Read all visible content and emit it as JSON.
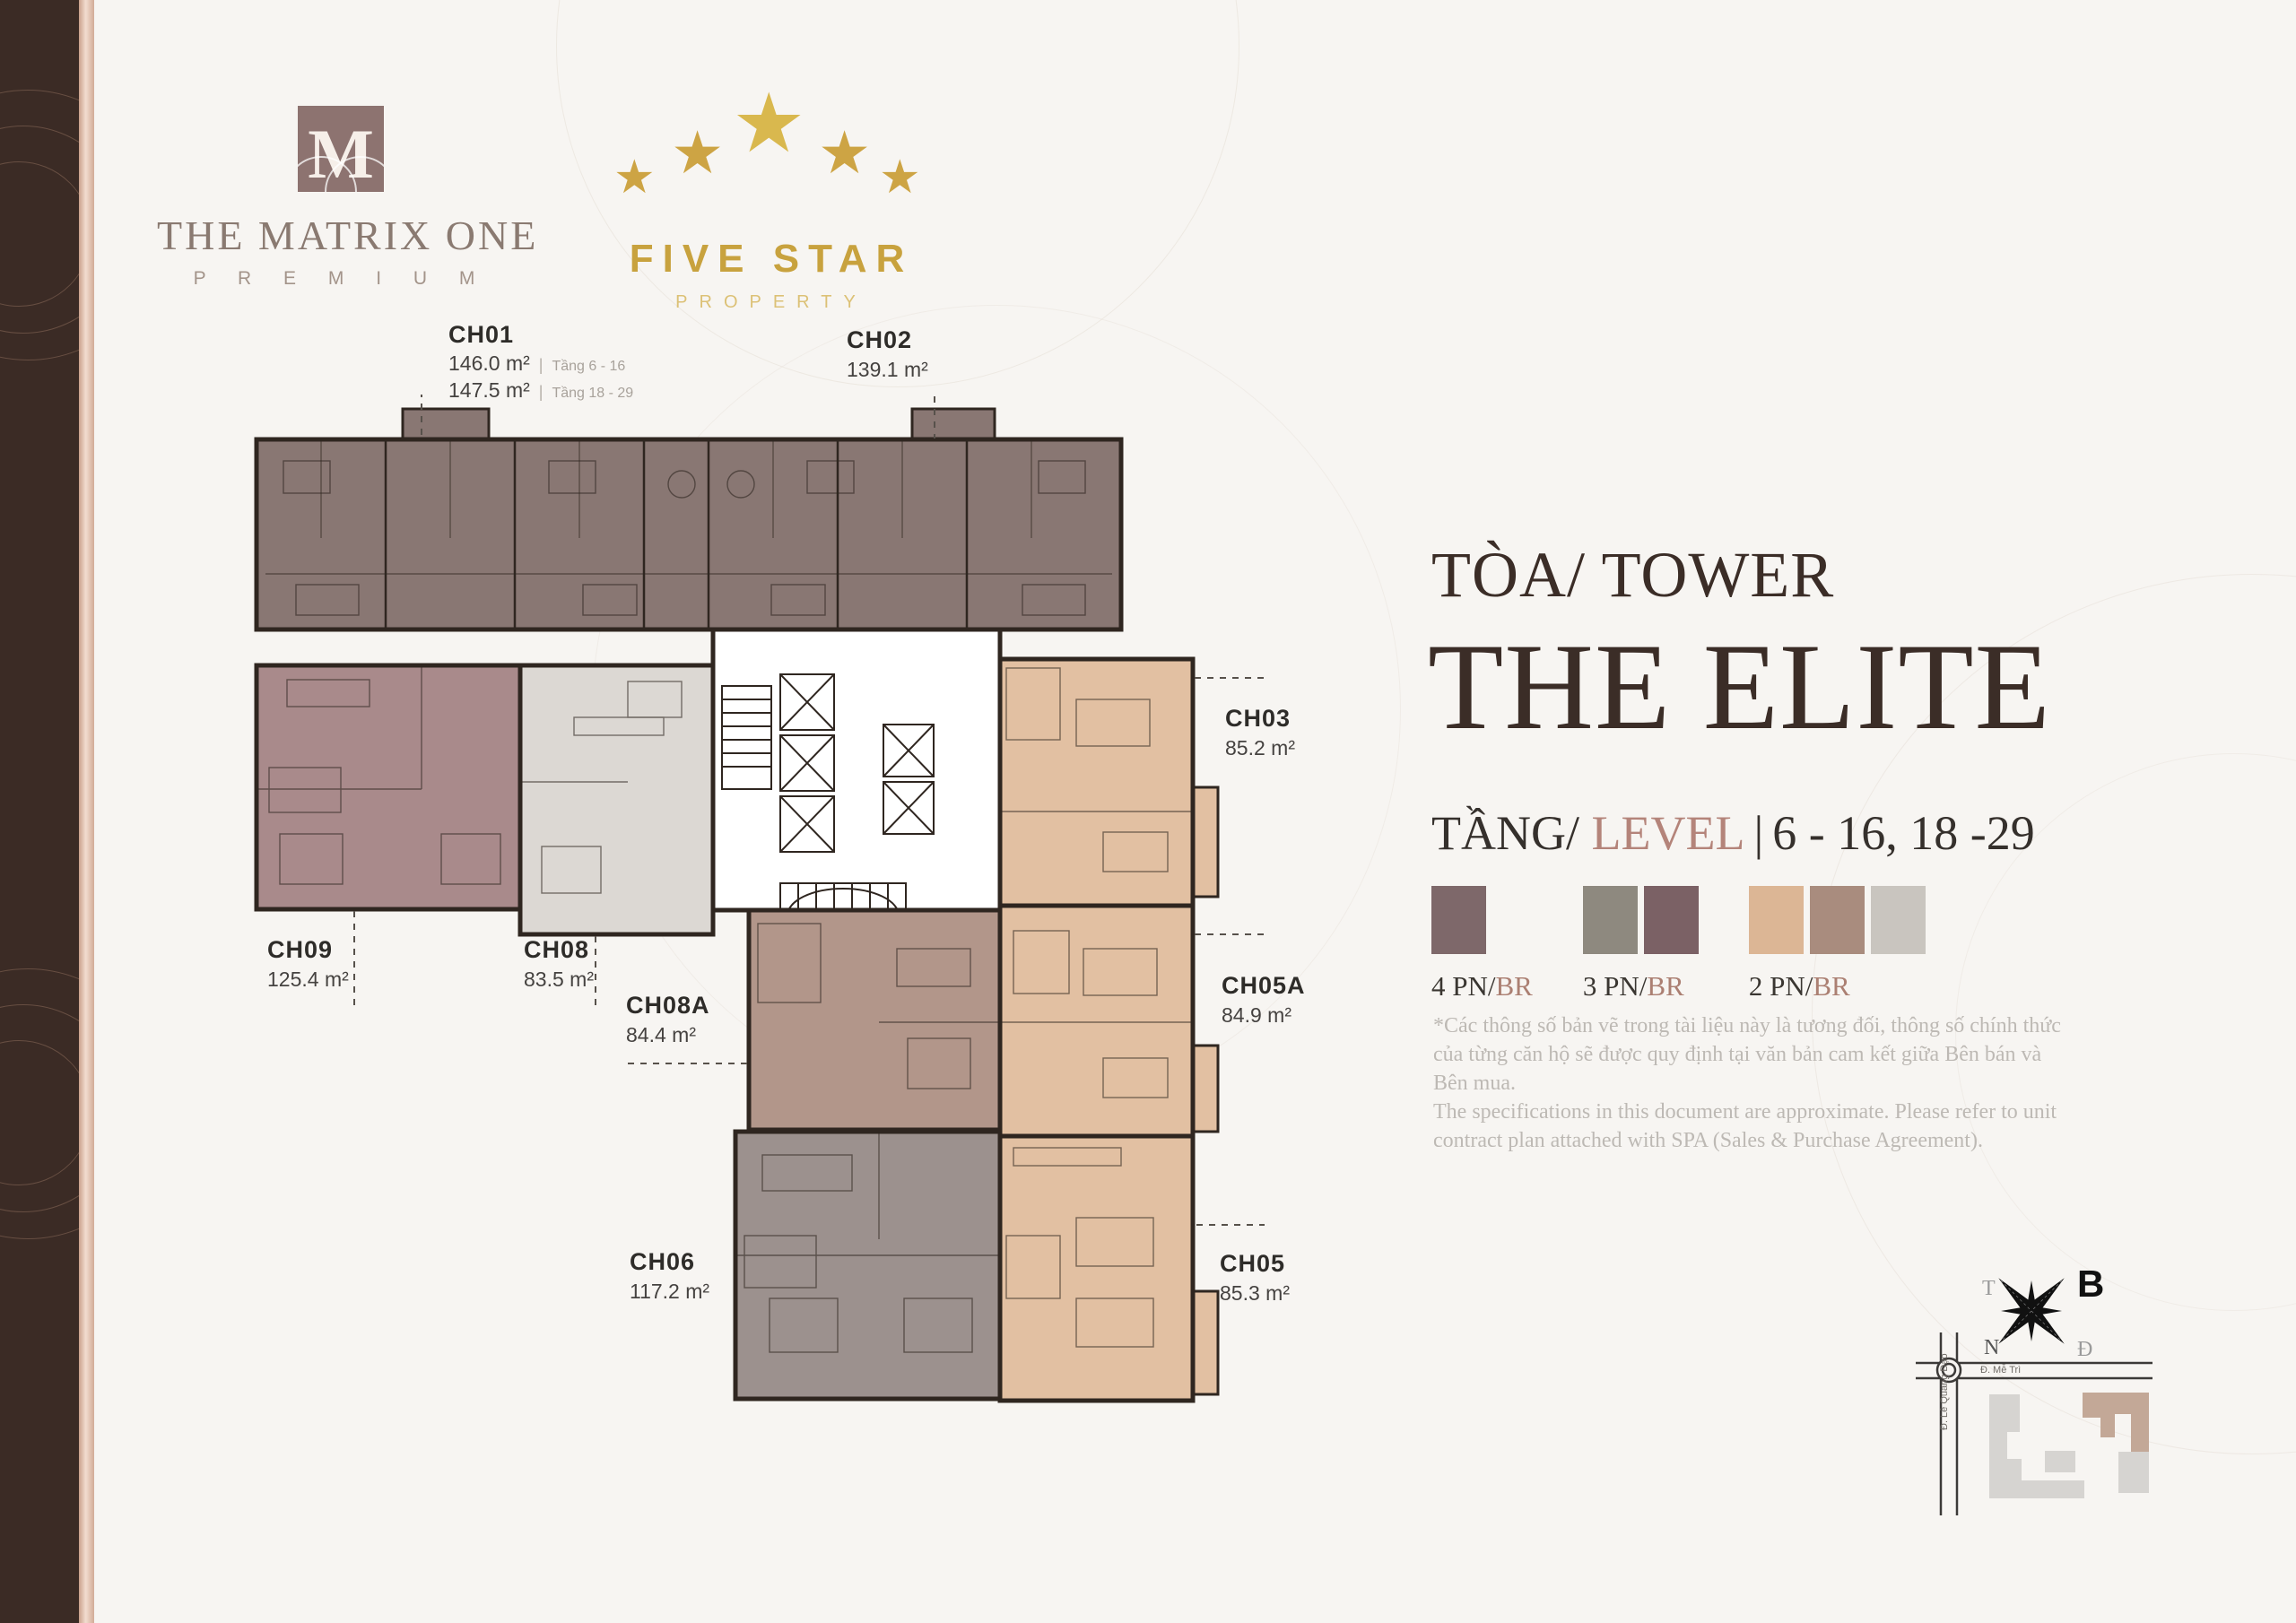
{
  "brand": {
    "matrix": {
      "monogram": "M",
      "title": "THE MATRIX ONE",
      "subtitle": "P R E M I U M"
    },
    "five_star": {
      "title": "FIVE STAR",
      "subtitle": "PROPERTY",
      "star_icon": "★"
    }
  },
  "tower": {
    "prefix": "TÒA/ TOWER",
    "name": "THE ELITE"
  },
  "level": {
    "vi": "TẦNG/ ",
    "en": "LEVEL",
    "separator": "|",
    "range": "6 - 16, 18 -29"
  },
  "legend": {
    "items": [
      {
        "pn": "4 PN/",
        "br": "BR",
        "colors": [
          "#7e686a"
        ]
      },
      {
        "pn": "3 PN/",
        "br": "BR",
        "colors": [
          "#8e897f",
          "#7b6165"
        ]
      },
      {
        "pn": "2 PN/",
        "br": "BR",
        "colors": [
          "#dcb695",
          "#a98c7e",
          "#c9c5bf"
        ]
      }
    ]
  },
  "units": [
    {
      "id": "CH01",
      "lines": [
        {
          "area": "146.0 m²",
          "sep": "|",
          "note": "Tầng 6 - 16"
        },
        {
          "area": "147.5 m²",
          "sep": "|",
          "note": "Tầng 18 - 29"
        }
      ]
    },
    {
      "id": "CH02",
      "area": "139.1 m²"
    },
    {
      "id": "CH03",
      "area": "85.2 m²"
    },
    {
      "id": "CH05A",
      "area": "84.9 m²"
    },
    {
      "id": "CH05",
      "area": "85.3 m²"
    },
    {
      "id": "CH06",
      "area": "117.2 m²"
    },
    {
      "id": "CH08",
      "area": "83.5 m²"
    },
    {
      "id": "CH08A",
      "area": "84.4 m²"
    },
    {
      "id": "CH09",
      "area": "125.4 m²"
    }
  ],
  "disclaimer": {
    "vi": "*Các thông số bản vẽ trong tài liệu này là tương đối, thông số chính thức của từng căn hộ sẽ được quy định tại văn bản cam kết giữa Bên bán và Bên mua.",
    "en": "The specifications in this document are approximate. Please refer to unit contract plan attached with SPA (Sales & Purchase Agreement)."
  },
  "compass": {
    "north": "B",
    "west": "T",
    "south": "N",
    "east": "Đ"
  },
  "map": {
    "road_horizontal": "Đ. Mễ Trì",
    "road_vertical": "Đ. Lê Quang Đạo"
  },
  "plan_colors": {
    "unit_4br": "#897773",
    "unit_3br_mauve": "#a98a8b",
    "unit_3br_gray": "#9c918e",
    "unit_2br_lightgray": "#dcd8d3",
    "unit_2br_tan": "#b2968a",
    "unit_2br_peach": "#e2c0a2",
    "wall": "#2f2620"
  }
}
